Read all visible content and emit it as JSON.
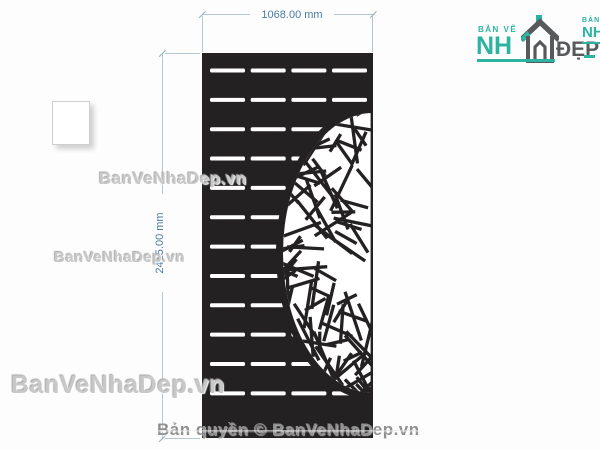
{
  "dims": {
    "width_label": "1068.00 mm",
    "height_label": "2415.00 mm"
  },
  "watermarks": {
    "wm1": "BanVeNhaDep.vn",
    "wm2": "BanVeNhaDep.vn",
    "wm3": "BanVeNhaDep.vn",
    "copyright": "Bản quyền © BanVeNhaDep.vn"
  },
  "brand": {
    "logo_small_text": "BẢN VẼ",
    "logo_main_left": "NH",
    "logo_main_right": "ĐẸP",
    "partial_logo_small_text": "BẢN V",
    "partial_logo_main": "NH"
  },
  "panel": {
    "slot_rows": 12,
    "slot_cols": 4,
    "motif": "crushed-ice semicircle cutout"
  },
  "colors": {
    "teal": "#2cb3a2",
    "logo_gray": "#58595b",
    "dim_text": "#4a7ba6",
    "dim_line": "#b2c7d0",
    "dim_tick": "#8fafbe",
    "panel": "#242122",
    "watermark": "#c8c8c8"
  }
}
